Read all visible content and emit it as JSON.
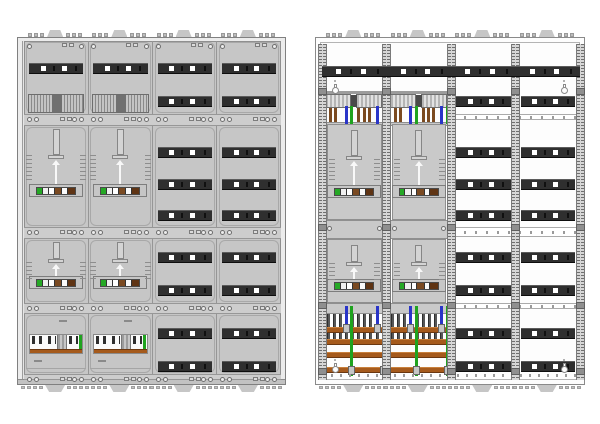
{
  "canvas": {
    "width": 600,
    "height": 424,
    "background": "#ffffff"
  },
  "drawing_title": "",
  "colors": {
    "cover": "#c6c6c6",
    "cover_light": "#ececec",
    "band": "#cdcdcd",
    "outline": "#808080",
    "outline_soft": "#9d9d9d",
    "rail_dark": "#2f2f2f",
    "rail_edge": "#5c5c5c",
    "open_bg": "#fdfdfd",
    "frame_rail": "#d6d6d6",
    "frame_hatch": "#6f6f6f",
    "busbar": "#a55a1c",
    "busbar_hi": "#c8803c",
    "busbar_lo": "#6a3710",
    "wire_brown": "#7b4a20",
    "wire_blue": "#2a35c8",
    "wire_green": "#1fa31f",
    "meter_seg_green": "#25a825",
    "meter_seg_brown": "#7a4a22",
    "meter_seg_brown2": "#5f3414",
    "screw": "#ececec",
    "prong": "#565656",
    "bump": "#c6c6c6"
  },
  "rail": {
    "h": 11,
    "square_fr": [
      0.22,
      0.6
    ],
    "mark_fr": [
      0.44,
      0.85
    ]
  },
  "meter_block_segments": [
    {
      "w": 5,
      "c": "$meter_seg_green"
    },
    {
      "w": 6,
      "c": "#f0f0f0"
    },
    {
      "w": 5,
      "c": "#ffffff"
    },
    {
      "w": 7,
      "c": "$meter_seg_brown"
    },
    {
      "w": 5,
      "c": "#fafafa"
    },
    {
      "w": 8,
      "c": "$meter_seg_brown2"
    }
  ],
  "cabinets": [
    {
      "view": "covered",
      "name": "meter-cabinet-front-covers",
      "x": 17,
      "y": 37,
      "width": 269,
      "height": 348,
      "field_count": 4,
      "columns": [
        "meter",
        "meter",
        "modules",
        "modules"
      ],
      "sections": [
        {
          "name": "terminal-section",
          "y": 3,
          "h": 73
        },
        {
          "name": "meter-row-1",
          "y": 88,
          "h": 101
        },
        {
          "name": "meter-row-2",
          "y": 201,
          "h": 64
        },
        {
          "name": "connection-section",
          "y": 276,
          "h": 60
        }
      ],
      "bands": [
        {
          "y": 76,
          "h": 12
        },
        {
          "y": 189,
          "h": 12
        },
        {
          "y": 265,
          "h": 11
        },
        {
          "y": 336,
          "h": 6
        }
      ],
      "module_rail_rows": [
        25,
        58,
        109,
        141,
        172,
        214,
        247,
        290,
        323
      ],
      "meter_rail_rows": [
        25
      ]
    },
    {
      "view": "open",
      "name": "meter-cabinet-open-frame",
      "x": 315,
      "y": 37,
      "width": 270,
      "height": 348,
      "field_count": 4,
      "columns": [
        "wired",
        "wired",
        "modules",
        "modules"
      ],
      "top_rail_y": 28,
      "module_rail_rows": [
        58,
        109,
        141,
        172,
        214,
        247,
        290,
        323
      ],
      "right_line_bands": [
        {
          "y": 76,
          "h": 6
        },
        {
          "y": 189,
          "h": 10
        },
        {
          "y": 265,
          "h": 6
        }
      ],
      "plates": [
        {
          "y": 86,
          "h": 96,
          "tall": true
        },
        {
          "y": 201,
          "h": 64,
          "tall": false
        }
      ],
      "gray_bands": [
        {
          "y": 84,
          "h": 4
        },
        {
          "y": 182,
          "h": 19
        },
        {
          "y": 265,
          "h": 11
        }
      ],
      "busbar_rows": [
        289,
        301,
        314,
        329
      ],
      "busbar_section_y": 276,
      "prongs": {
        "count": 9,
        "start_fr": 0.07,
        "step_fr": 0.095,
        "h": 30
      },
      "wires": {
        "brown_fr": [
          0.03,
          0.11,
          0.19,
          0.55,
          0.63,
          0.71
        ],
        "blue_fr": [
          0.35,
          0.83
        ],
        "green_fr": [
          0.44,
          0.93
        ]
      },
      "keyholes": [
        [
          16,
          46
        ],
        [
          245,
          46
        ],
        [
          16,
          325
        ],
        [
          245,
          325
        ]
      ]
    }
  ]
}
